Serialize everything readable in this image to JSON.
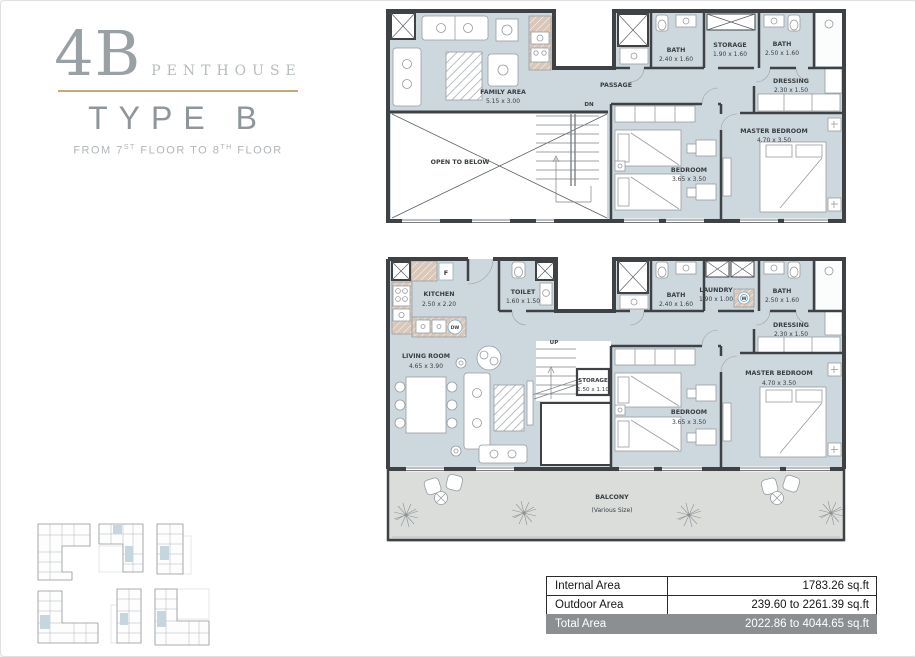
{
  "header": {
    "unit": "4B",
    "program": "PENTHOUSE",
    "type_label": "TYPE B",
    "floors": {
      "p1": "FROM 7",
      "sup1": "ST",
      "p2": " FLOOR TO 8",
      "sup2": "TH",
      "p3": " FLOOR"
    }
  },
  "plans": {
    "upper": {
      "rooms": {
        "family": {
          "name": "FAMILY AREA",
          "dims": "5.15 x 3.00"
        },
        "bath1": {
          "name": "BATH",
          "dims": "2.40 x 1.60"
        },
        "storage": {
          "name": "STORAGE",
          "dims": "1.90 x 1.60"
        },
        "bath2": {
          "name": "BATH",
          "dims": "2.50 x 1.60"
        },
        "dressing": {
          "name": "DRESSING",
          "dims": "2.30 x 1.50"
        },
        "master": {
          "name": "MASTER BEDROOM",
          "dims": "4.70 x 3.50"
        },
        "bedroom": {
          "name": "BEDROOM",
          "dims": "3.65 x 3.50"
        }
      },
      "labels": {
        "passage": "PASSAGE",
        "dn": "DN",
        "open_to_below": "OPEN TO BELOW"
      }
    },
    "lower": {
      "rooms": {
        "kitchen": {
          "name": "KITCHEN",
          "dims": "2.50 x 2.20"
        },
        "toilet": {
          "name": "TOILET",
          "dims": "1.60 x 1.50"
        },
        "bath1": {
          "name": "BATH",
          "dims": "2.40 x 1.60"
        },
        "laundry": {
          "name": "LAUNDRY",
          "dims": "1.90 x 1.00"
        },
        "bath2": {
          "name": "BATH",
          "dims": "2.50 x 1.60"
        },
        "dressing": {
          "name": "DRESSING",
          "dims": "2.30 x 1.50"
        },
        "master": {
          "name": "MASTER BEDROOM",
          "dims": "4.70 x 3.50"
        },
        "bedroom": {
          "name": "BEDROOM",
          "dims": "3.65 x 3.50"
        },
        "storage": {
          "name": "STORAGE",
          "dims": "1.50 x 1.10"
        },
        "living": {
          "name": "LIVING ROOM",
          "dims": "4.65 x 3.90"
        },
        "balcony": {
          "name": "BALCONY",
          "note": "(Various Size)"
        }
      },
      "labels": {
        "up": "UP"
      },
      "appliances": {
        "fridge": "F",
        "dishwasher": "DW",
        "washer": "W"
      }
    }
  },
  "area_table": {
    "rows": [
      {
        "label": "Internal Area",
        "value": "1783.26 sq.ft"
      },
      {
        "label": "Outdoor Area",
        "value": "239.60 to 2261.39 sq.ft"
      },
      {
        "label": "Total Area",
        "value": "2022.86 to 4044.65 sq.ft"
      }
    ]
  },
  "colors": {
    "accent_gold": "#c8a678",
    "floor_fill": "#cdd8de",
    "balcony_fill": "#dbddda",
    "wall": "#3f4245",
    "total_row_bg": "#8c8f91",
    "unit_highlight_blue": "#c6d6df"
  }
}
